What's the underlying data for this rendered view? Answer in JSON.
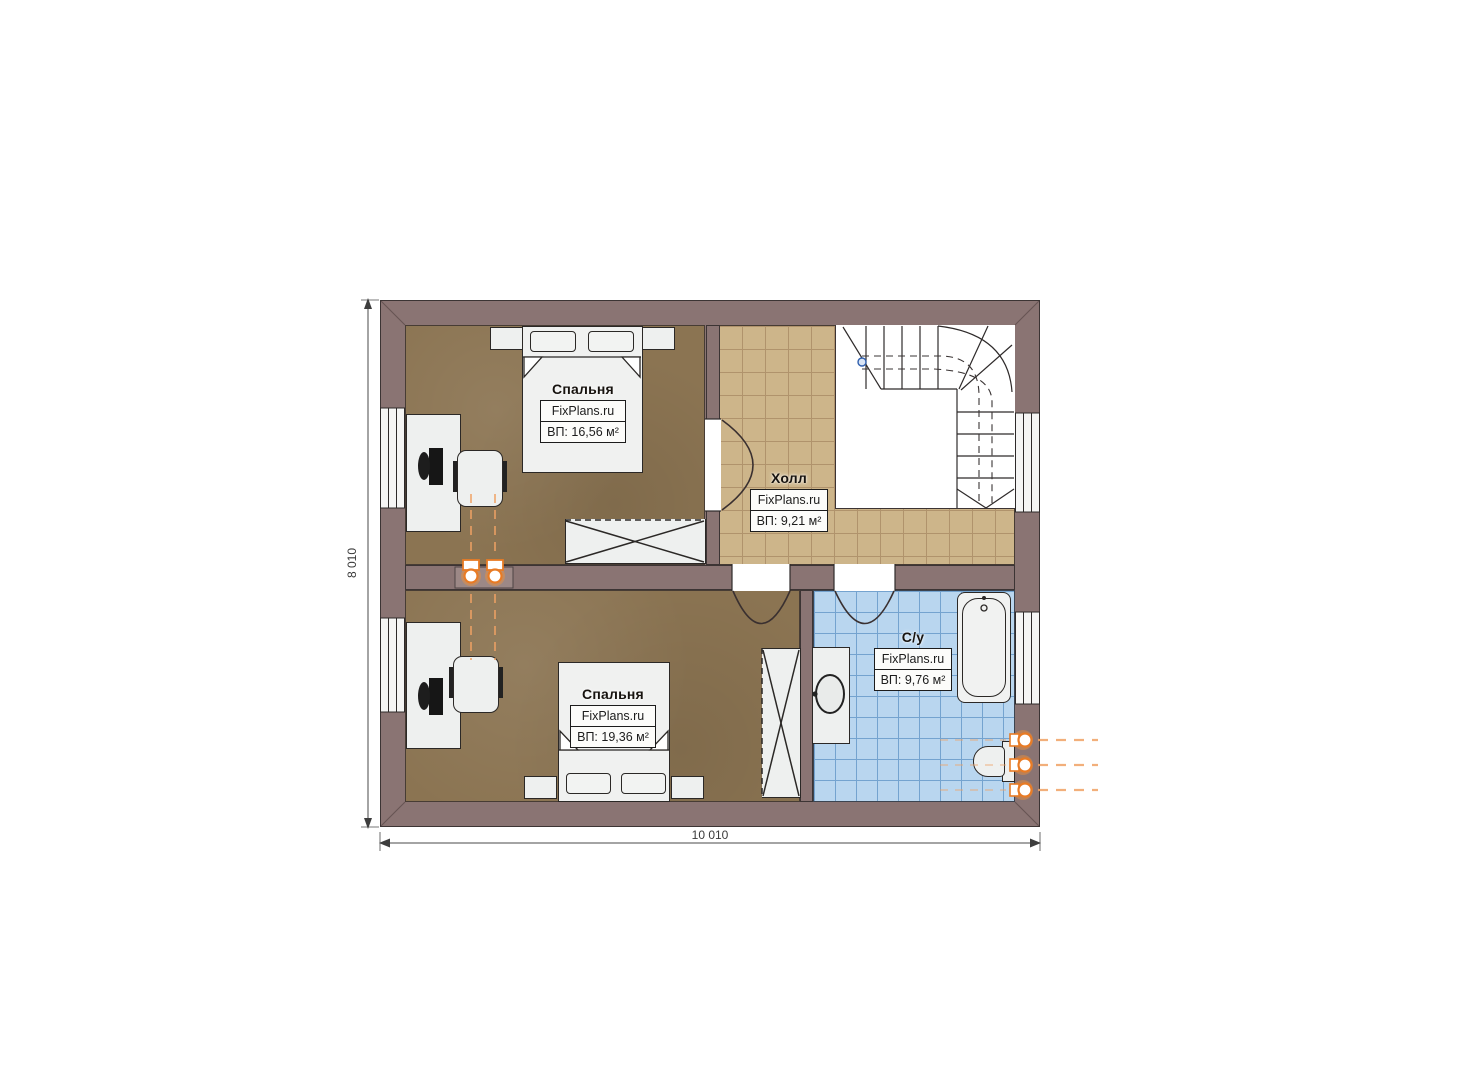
{
  "plan": {
    "title": "floor-plan-second-level",
    "rooms": {
      "bedroom1": {
        "name": "Спальня",
        "brand": "FixPlans.ru",
        "area": "ВП: 16,56 м²"
      },
      "hall": {
        "name": "Холл",
        "brand": "FixPlans.ru",
        "area": "ВП: 9,21 м²"
      },
      "bedroom2": {
        "name": "Спальня",
        "brand": "FixPlans.ru",
        "area": "ВП: 19,36 м²"
      },
      "bathroom": {
        "name": "С/у",
        "brand": "FixPlans.ru",
        "area": "ВП: 9,76 м²"
      }
    },
    "dimensions": {
      "width_label": "10 010",
      "height_label": "8 010"
    },
    "colors": {
      "wall": "#8a7473",
      "bedroom_floor": "#8b7452",
      "hall_tile": "#cdb58a",
      "bathroom_tile": "#b9d6ef",
      "accent_orange": "#e87b25"
    }
  }
}
